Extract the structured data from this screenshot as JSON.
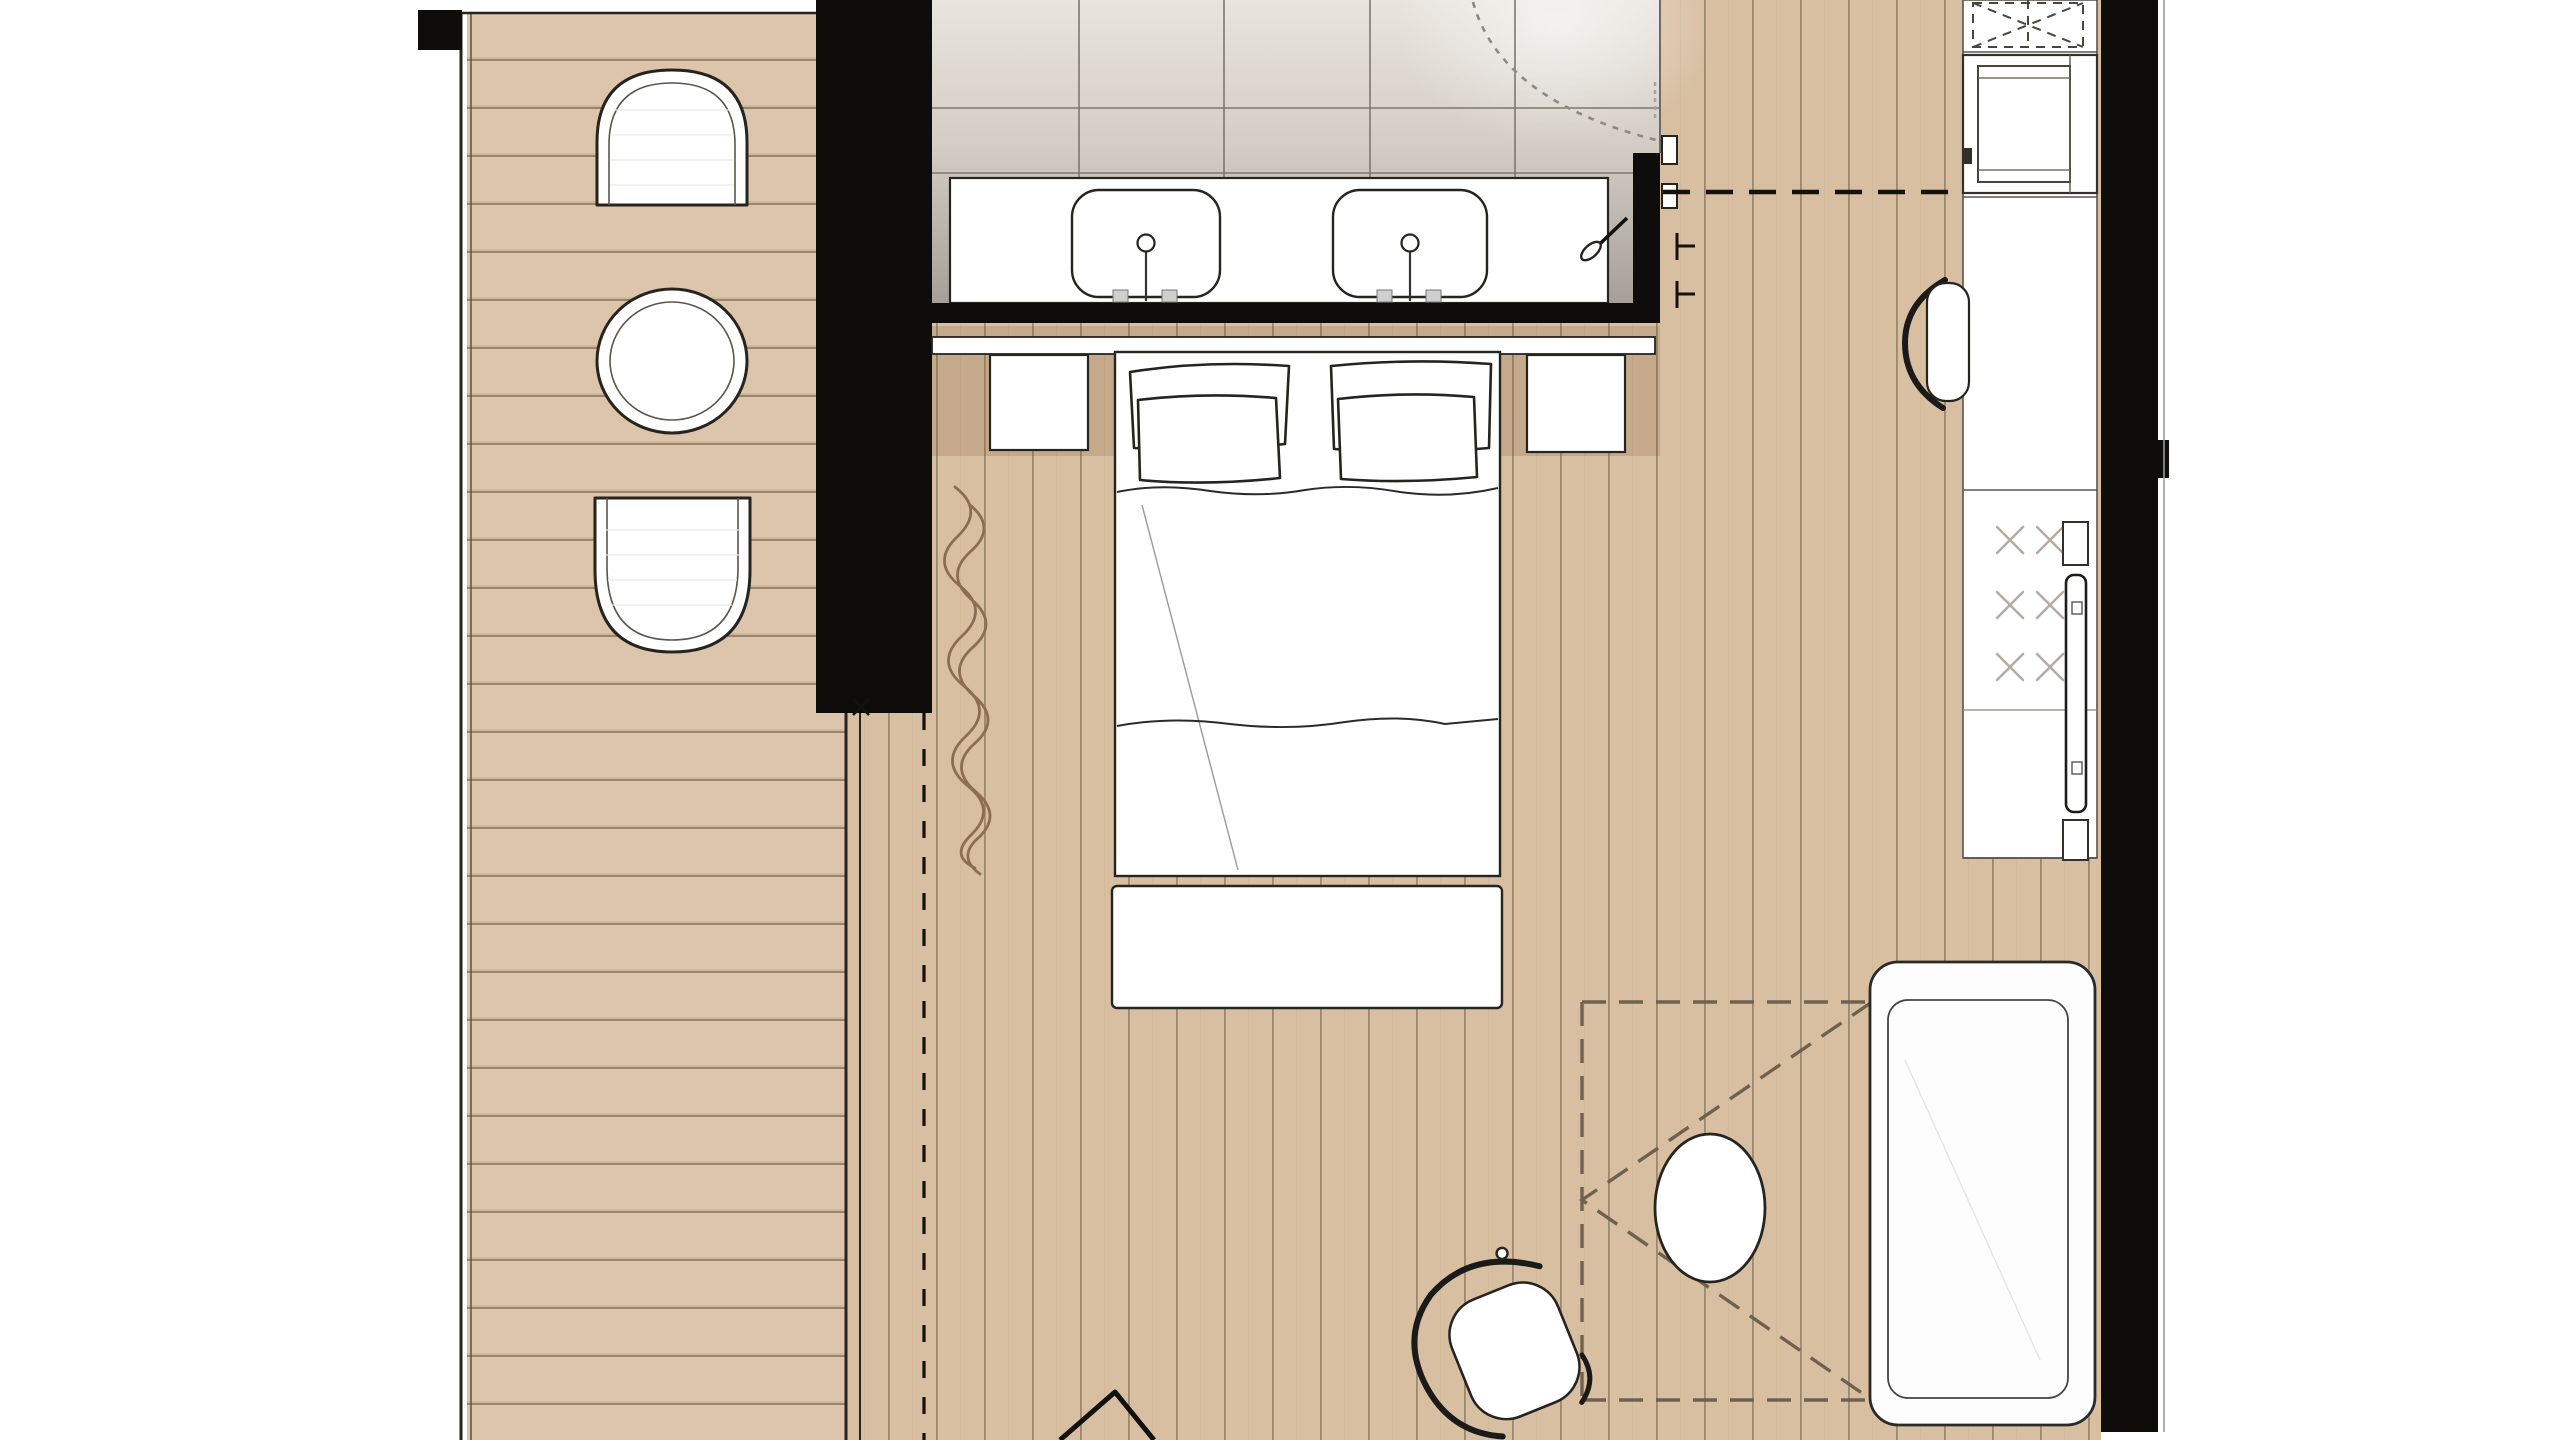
{
  "document": {
    "kind": "floor-plan-rendering",
    "visible_text": [],
    "canvas": {
      "width_px": 2560,
      "height_px": 1440
    }
  },
  "colors": {
    "wall": "#0e0d0c",
    "ink": "#26241f",
    "soft": "#5a554d",
    "deck-wood": "#dcc5aa",
    "room-wood": "#d8bfa2",
    "plank-line": "#8d7963",
    "tile-top": "#e9e4de",
    "tile-mid": "#d4cdc6",
    "tile-low": "#b3aca5",
    "tile-dark": "#a19a92",
    "tile-line": "#7d776f",
    "furn": "#ffffff",
    "dash-brown": "#70614f",
    "curtain": "#8a6d52",
    "glass-x": "#b5ada2",
    "outer-line": "#9b9b9b",
    "shadow-band": "rgba(122,85,48,0.20)"
  },
  "objects": [
    {
      "name": "deck",
      "type": "outdoor-wood-deck",
      "plank_direction": "horizontal"
    },
    {
      "name": "deck-lounge-chair-top",
      "type": "arch-chair"
    },
    {
      "name": "deck-round-table",
      "type": "round-table"
    },
    {
      "name": "deck-lounge-chair-bottom",
      "type": "arch-chair"
    },
    {
      "name": "privacy-wall",
      "type": "solid-black-wall"
    },
    {
      "name": "curtain",
      "type": "squiggle-symbol"
    },
    {
      "name": "curtain-track",
      "type": "dashed-line"
    },
    {
      "name": "bathroom",
      "type": "tiled-room"
    },
    {
      "name": "vanity-counter",
      "type": "counter",
      "sink_count": 2
    },
    {
      "name": "sink-left",
      "type": "basin-with-faucet"
    },
    {
      "name": "sink-right",
      "type": "basin-with-faucet"
    },
    {
      "name": "door-swing",
      "type": "dashed-arc"
    },
    {
      "name": "door-handle",
      "type": "lever-symbol"
    },
    {
      "name": "bed",
      "type": "double-bed",
      "pillow_count": 4
    },
    {
      "name": "headboard-shelf",
      "type": "shelf"
    },
    {
      "name": "nightstand-left",
      "type": "nightstand"
    },
    {
      "name": "nightstand-right",
      "type": "nightstand"
    },
    {
      "name": "foot-bench",
      "type": "bench"
    },
    {
      "name": "ceiling-projection",
      "type": "dashed-rectangle-with-diagonals"
    },
    {
      "name": "pouf-table",
      "type": "oval-pouf"
    },
    {
      "name": "swivel-chair",
      "type": "lounge-chair"
    },
    {
      "name": "daybed",
      "type": "upholstered-daybed"
    },
    {
      "name": "tall-column",
      "type": "cabinetry-column"
    },
    {
      "name": "overhead-cabinet",
      "type": "dashed-cross-symbol"
    },
    {
      "name": "appliance",
      "type": "built-in-appliance"
    },
    {
      "name": "desk-chair",
      "type": "crescent-back-chair"
    },
    {
      "name": "glass-cabinet",
      "type": "cabinet",
      "glass_mark_count": 6
    },
    {
      "name": "tv",
      "type": "wall-mounted-tv"
    },
    {
      "name": "right-wall",
      "type": "solid-black-wall"
    },
    {
      "name": "entry-marker",
      "type": "triangle-symbol"
    }
  ]
}
